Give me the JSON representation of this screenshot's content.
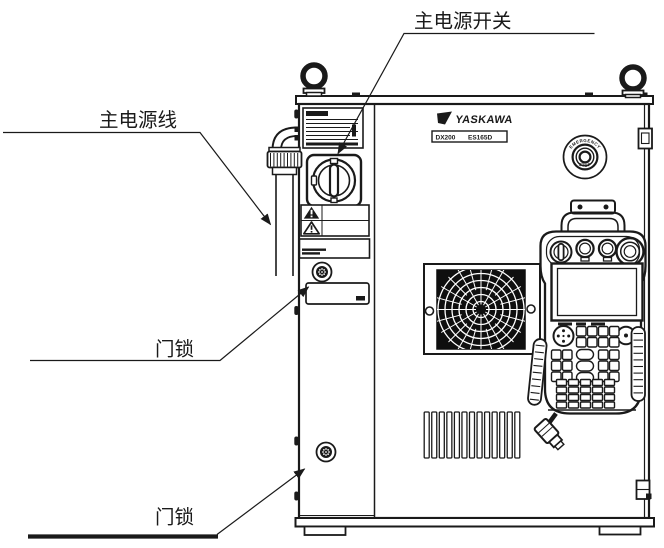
{
  "callouts": {
    "main_power_switch": "主电源开关",
    "main_power_cable": "主电源线",
    "door_lock_upper": "门锁",
    "door_lock_lower": "门锁"
  },
  "cabinet": {
    "brand": "YASKAWA",
    "model_series": "DX200",
    "model_robot": "ES165D",
    "estop_text_top": "EMERGENCY",
    "estop_text_bottom": "STOP"
  },
  "colors": {
    "ink": "#1a1a1a",
    "paper": "#ffffff"
  }
}
